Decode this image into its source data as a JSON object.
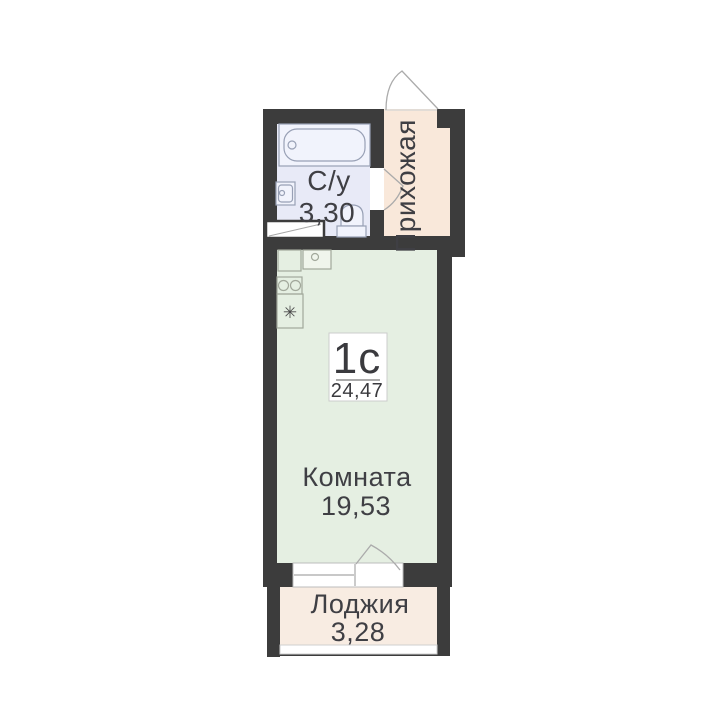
{
  "unit": {
    "type_label": "1с",
    "total_area": "24,47"
  },
  "rooms": {
    "bathroom": {
      "label": "С/у",
      "area": "3,30"
    },
    "hallway": {
      "label": "Прихожая"
    },
    "living": {
      "label": "Комната",
      "area": "19,53"
    },
    "loggia": {
      "label": "Лоджия",
      "area": "3,28"
    }
  },
  "icons": {
    "fridge": "✳"
  },
  "colors": {
    "wall": "#3c3c3c",
    "bathroom_floor": "#e8eaf7",
    "hallway_floor": "#f9e8da",
    "room_floor": "#e5efe2",
    "loggia_floor": "#f8ece2",
    "bath_fixture_stroke": "#98a0b5",
    "kitchen_fixture_stroke": "#a2a89b",
    "door_arc_stroke": "#ababab",
    "text_color": "#3f3f44",
    "fixture_fill": "#f1f3fc",
    "label_box_border": "#cccccc"
  }
}
